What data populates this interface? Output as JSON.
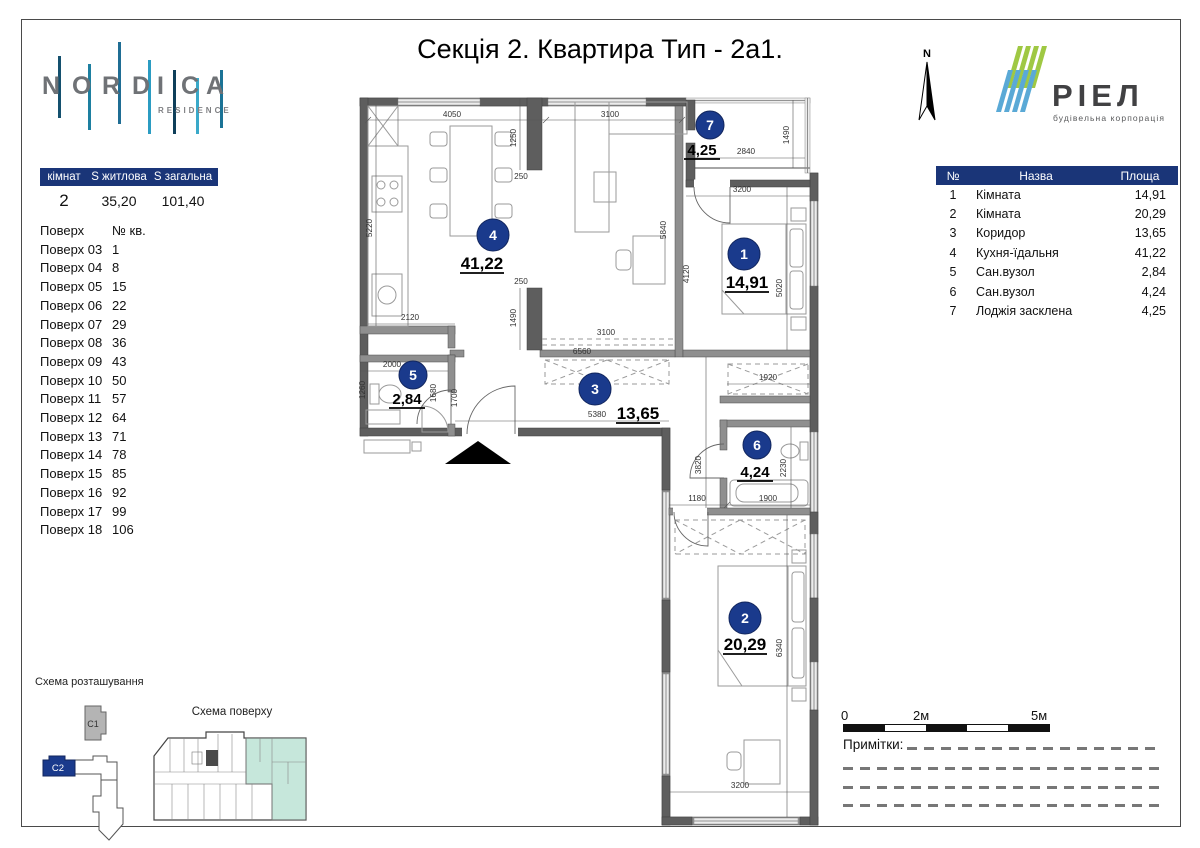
{
  "title": "Секція 2. Квартира Тип - 2а1.",
  "brand": {
    "letters": [
      "N",
      "O",
      "R",
      "D",
      "I",
      "C",
      "A"
    ],
    "sub": "RESIDENCE"
  },
  "developer": {
    "name": "РІЕЛ",
    "sub": "будівельна корпорація"
  },
  "compass": {
    "label": "N"
  },
  "summary_table": {
    "headers": [
      "кімнат",
      "S житлова",
      "S загальна"
    ],
    "values": [
      "2",
      "35,20",
      "101,40"
    ]
  },
  "floors_list": {
    "headers": [
      "Поверх",
      "№ кв."
    ],
    "rows": [
      [
        "Поверх 03",
        "1"
      ],
      [
        "Поверх 04",
        "8"
      ],
      [
        "Поверх 05",
        "15"
      ],
      [
        "Поверх 06",
        "22"
      ],
      [
        "Поверх 07",
        "29"
      ],
      [
        "Поверх 08",
        "36"
      ],
      [
        "Поверх 09",
        "43"
      ],
      [
        "Поверх 10",
        "50"
      ],
      [
        "Поверх 11",
        "57"
      ],
      [
        "Поверх 12",
        "64"
      ],
      [
        "Поверх 13",
        "71"
      ],
      [
        "Поверх 14",
        "78"
      ],
      [
        "Поверх 15",
        "85"
      ],
      [
        "Поверх 16",
        "92"
      ],
      [
        "Поверх 17",
        "99"
      ],
      [
        "Поверх 18",
        "106"
      ]
    ]
  },
  "rooms_table": {
    "headers": [
      "№",
      "Назва",
      "Площа"
    ],
    "rows": [
      [
        "1",
        "Кімната",
        "14,91"
      ],
      [
        "2",
        "Кімната",
        "20,29"
      ],
      [
        "3",
        "Коридор",
        "13,65"
      ],
      [
        "4",
        "Кухня-їдальня",
        "41,22"
      ],
      [
        "5",
        "Сан.вузол",
        "2,84"
      ],
      [
        "6",
        "Сан.вузол",
        "4,24"
      ],
      [
        "7",
        "Лоджія засклена",
        "4,25"
      ]
    ]
  },
  "plan": {
    "rooms": [
      {
        "n": "1",
        "a": "14,91",
        "cx": 394,
        "cy": 166,
        "r": 16,
        "ax": 397,
        "ay": 200,
        "big": true
      },
      {
        "n": "2",
        "a": "20,29",
        "cx": 395,
        "cy": 530,
        "r": 16,
        "ax": 395,
        "ay": 562,
        "big": true
      },
      {
        "n": "3",
        "a": "13,65",
        "cx": 245,
        "cy": 301,
        "r": 16,
        "ax": 288,
        "ay": 331,
        "big": true
      },
      {
        "n": "4",
        "a": "41,22",
        "cx": 143,
        "cy": 147,
        "r": 16,
        "ax": 132,
        "ay": 181,
        "big": true
      },
      {
        "n": "5",
        "a": "2,84",
        "cx": 63,
        "cy": 287,
        "r": 14,
        "ax": 57,
        "ay": 316,
        "big": false
      },
      {
        "n": "6",
        "a": "4,24",
        "cx": 407,
        "cy": 357,
        "r": 14,
        "ax": 405,
        "ay": 389,
        "big": false
      },
      {
        "n": "7",
        "a": "4,25",
        "cx": 360,
        "cy": 37,
        "r": 14,
        "ax": 352,
        "ay": 67,
        "big": false
      }
    ],
    "dims": [
      {
        "v": "4050",
        "x": 102,
        "y": 29,
        "r": 0
      },
      {
        "v": "3100",
        "x": 260,
        "y": 29,
        "r": 0
      },
      {
        "v": "2840",
        "x": 396,
        "y": 66,
        "r": 0
      },
      {
        "v": "1490",
        "x": 439,
        "y": 47,
        "r": -90
      },
      {
        "v": "1250",
        "x": 166,
        "y": 50,
        "r": -90
      },
      {
        "v": "250",
        "x": 171,
        "y": 91,
        "r": 0
      },
      {
        "v": "3200",
        "x": 392,
        "y": 104,
        "r": 0
      },
      {
        "v": "5220",
        "x": 22,
        "y": 140,
        "r": -90
      },
      {
        "v": "5840",
        "x": 316,
        "y": 142,
        "r": -90
      },
      {
        "v": "4120",
        "x": 339,
        "y": 186,
        "r": -90
      },
      {
        "v": "5020",
        "x": 432,
        "y": 200,
        "r": -90
      },
      {
        "v": "250",
        "x": 171,
        "y": 196,
        "r": 0
      },
      {
        "v": "1490",
        "x": 166,
        "y": 230,
        "r": -90
      },
      {
        "v": "3100",
        "x": 256,
        "y": 247,
        "r": 0
      },
      {
        "v": "2120",
        "x": 60,
        "y": 232,
        "r": 0
      },
      {
        "v": "6560",
        "x": 232,
        "y": 266,
        "r": 0
      },
      {
        "v": "5380",
        "x": 247,
        "y": 329,
        "r": 0
      },
      {
        "v": "2000",
        "x": 42,
        "y": 279,
        "r": 0
      },
      {
        "v": "1260",
        "x": 15,
        "y": 302,
        "r": -90
      },
      {
        "v": "1680",
        "x": 86,
        "y": 305,
        "r": -90
      },
      {
        "v": "1700",
        "x": 107,
        "y": 310,
        "r": -90
      },
      {
        "v": "1920",
        "x": 418,
        "y": 292,
        "r": 0
      },
      {
        "v": "3820",
        "x": 351,
        "y": 377,
        "r": -90
      },
      {
        "v": "2230",
        "x": 436,
        "y": 380,
        "r": -90
      },
      {
        "v": "1180",
        "x": 347,
        "y": 413,
        "r": 0
      },
      {
        "v": "1900",
        "x": 418,
        "y": 413,
        "r": 0
      },
      {
        "v": "6340",
        "x": 432,
        "y": 560,
        "r": -90
      },
      {
        "v": "3200",
        "x": 390,
        "y": 700,
        "r": 0
      }
    ]
  },
  "location_scheme": {
    "title": "Схема розташування",
    "buildings": [
      {
        "label": "C1"
      },
      {
        "label": "C2"
      }
    ]
  },
  "floor_scheme": {
    "title": "Схема поверху"
  },
  "scale_bar": {
    "labels": [
      "0",
      "2м",
      "5м"
    ]
  },
  "notes": {
    "label": "Примітки:"
  },
  "colors": {
    "navy": "#1a3578",
    "circle_navy": "#1a3a8c",
    "mint": "#c6e7db",
    "riel_green": "#9fc843",
    "riel_blue": "#5aa9d6"
  }
}
